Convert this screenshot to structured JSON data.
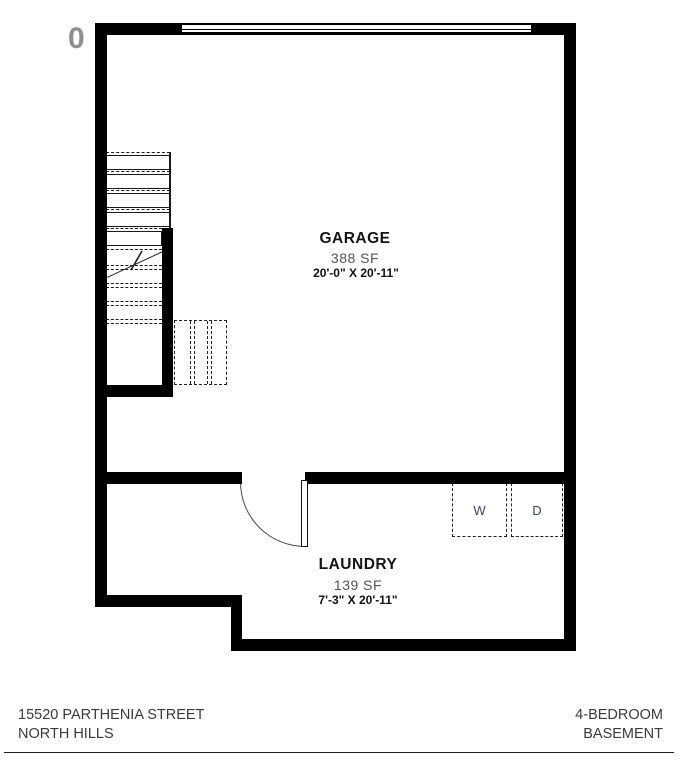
{
  "watermark": {
    "glyph": "0"
  },
  "rooms": {
    "garage": {
      "name": "GARAGE",
      "area": "388 SF",
      "dimensions": "20'-0\" X 20'-11\""
    },
    "laundry": {
      "name": "LAUNDRY",
      "area": "139 SF",
      "dimensions": "7'-3\" X 20'-11\""
    }
  },
  "appliances": {
    "washer": "W",
    "dryer": "D"
  },
  "footer": {
    "address_line1": "15520 PARTHENIA STREET",
    "address_line2": "NORTH HILLS",
    "plan_line1": "4-BEDROOM",
    "plan_line2": "BASEMENT"
  },
  "colors": {
    "wall": "#000000",
    "thin_line": "#1a1a1a",
    "muted_text": "#555555",
    "appliance_text": "#3a4654",
    "footer_text": "#3b3b3b",
    "watermark": "#8f8f8f"
  }
}
